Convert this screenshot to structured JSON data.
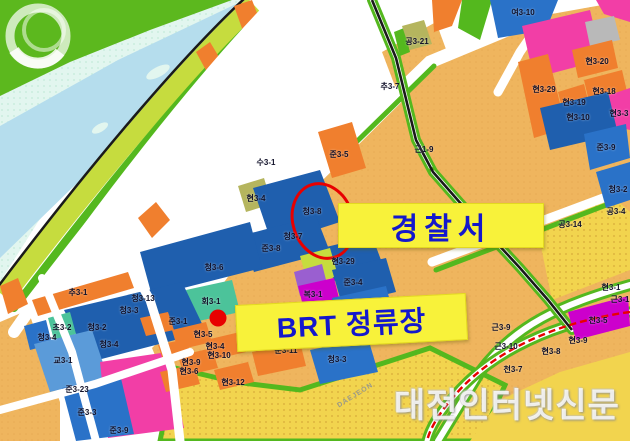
{
  "map": {
    "annotations": {
      "police_label": "경찰서",
      "brt_label": "BRT 정류장"
    },
    "watermark": {
      "logo_text": "DAEJEON",
      "site_text": "대전인터넷신문"
    },
    "parcel_labels": [
      {
        "text": "여3-10",
        "x": 523,
        "y": 13
      },
      {
        "text": "공3-21",
        "x": 417,
        "y": 42
      },
      {
        "text": "추3-7",
        "x": 390,
        "y": 87
      },
      {
        "text": "현3-20",
        "x": 597,
        "y": 62
      },
      {
        "text": "현3-29",
        "x": 544,
        "y": 90
      },
      {
        "text": "현3-18",
        "x": 604,
        "y": 92
      },
      {
        "text": "현3-19",
        "x": 574,
        "y": 103
      },
      {
        "text": "현3-10",
        "x": 578,
        "y": 118
      },
      {
        "text": "현3-3",
        "x": 619,
        "y": 114
      },
      {
        "text": "준3-9",
        "x": 606,
        "y": 148
      },
      {
        "text": "근1-9",
        "x": 424,
        "y": 150
      },
      {
        "text": "수3-1",
        "x": 266,
        "y": 163
      },
      {
        "text": "준3-5",
        "x": 339,
        "y": 155
      },
      {
        "text": "현3-4",
        "x": 256,
        "y": 199
      },
      {
        "text": "청3-8",
        "x": 312,
        "y": 212
      },
      {
        "text": "청3-7",
        "x": 293,
        "y": 237
      },
      {
        "text": "준3-8",
        "x": 271,
        "y": 249
      },
      {
        "text": "청3-6",
        "x": 214,
        "y": 268
      },
      {
        "text": "청3-2",
        "x": 618,
        "y": 190
      },
      {
        "text": "공3-4",
        "x": 616,
        "y": 212
      },
      {
        "text": "공3-14",
        "x": 570,
        "y": 225
      },
      {
        "text": "공3-13",
        "x": 505,
        "y": 243
      },
      {
        "text": "현3-29",
        "x": 343,
        "y": 262
      },
      {
        "text": "준3-4",
        "x": 353,
        "y": 283
      },
      {
        "text": "복3-1",
        "x": 313,
        "y": 295
      },
      {
        "text": "청3-5",
        "x": 362,
        "y": 311
      },
      {
        "text": "회3-1",
        "x": 211,
        "y": 302
      },
      {
        "text": "준3-1",
        "x": 178,
        "y": 322
      },
      {
        "text": "추3-1",
        "x": 78,
        "y": 293
      },
      {
        "text": "청3-13",
        "x": 143,
        "y": 299
      },
      {
        "text": "청3-3",
        "x": 129,
        "y": 311
      },
      {
        "text": "초3-2",
        "x": 62,
        "y": 328
      },
      {
        "text": "청3-2",
        "x": 97,
        "y": 328
      },
      {
        "text": "청3-4",
        "x": 47,
        "y": 338
      },
      {
        "text": "청3-4",
        "x": 109,
        "y": 345
      },
      {
        "text": "교3-1",
        "x": 63,
        "y": 361
      },
      {
        "text": "준3-23",
        "x": 77,
        "y": 390
      },
      {
        "text": "준3-3",
        "x": 87,
        "y": 413
      },
      {
        "text": "준3-9",
        "x": 119,
        "y": 431
      },
      {
        "text": "현3-5",
        "x": 203,
        "y": 335
      },
      {
        "text": "현3-4",
        "x": 215,
        "y": 347
      },
      {
        "text": "현3-10",
        "x": 219,
        "y": 356
      },
      {
        "text": "현3-9",
        "x": 191,
        "y": 363
      },
      {
        "text": "현3-6",
        "x": 189,
        "y": 372
      },
      {
        "text": "현3-12",
        "x": 233,
        "y": 383
      },
      {
        "text": "공3-11",
        "x": 263,
        "y": 341
      },
      {
        "text": "청3-12",
        "x": 299,
        "y": 342
      },
      {
        "text": "준3-11",
        "x": 286,
        "y": 351
      },
      {
        "text": "청3-3",
        "x": 337,
        "y": 360
      },
      {
        "text": "근3-9",
        "x": 501,
        "y": 328
      },
      {
        "text": "근3-10",
        "x": 506,
        "y": 347
      },
      {
        "text": "천3-5",
        "x": 598,
        "y": 321
      },
      {
        "text": "현3-1",
        "x": 611,
        "y": 288
      },
      {
        "text": "근3-1",
        "x": 620,
        "y": 300
      },
      {
        "text": "현3-9",
        "x": 578,
        "y": 341
      },
      {
        "text": "현3-8",
        "x": 551,
        "y": 352
      },
      {
        "text": "천3-7",
        "x": 513,
        "y": 370
      }
    ],
    "colors": {
      "water": "#b5dded",
      "plain": "#e2f6ef",
      "plain_dot": "#c4ead9",
      "hill": "#5cb81e",
      "band": "#c6dc3e",
      "green_strip": "#54b81e",
      "road": "#ffffff",
      "orange": "#f07f2e",
      "tan": "#efb55e",
      "tan_dot": "#dfa04a",
      "yellow": "#f2d44e",
      "yellow_dot": "#d8ab39",
      "pink": "#f23ea6",
      "magenta": "#cc00cc",
      "purple": "#9a5fd0",
      "blue": "#2a72c8",
      "blue_dark": "#1f5fae",
      "blue_light": "#5b9bd9",
      "teal": "#4cc39a",
      "khaki": "#b5b55e",
      "grey": "#b9b9b9",
      "red": "#e80000",
      "black_line": "#1a1a1a",
      "callout_bg": "#f8f23a",
      "callout_text": "#1418cc"
    }
  }
}
